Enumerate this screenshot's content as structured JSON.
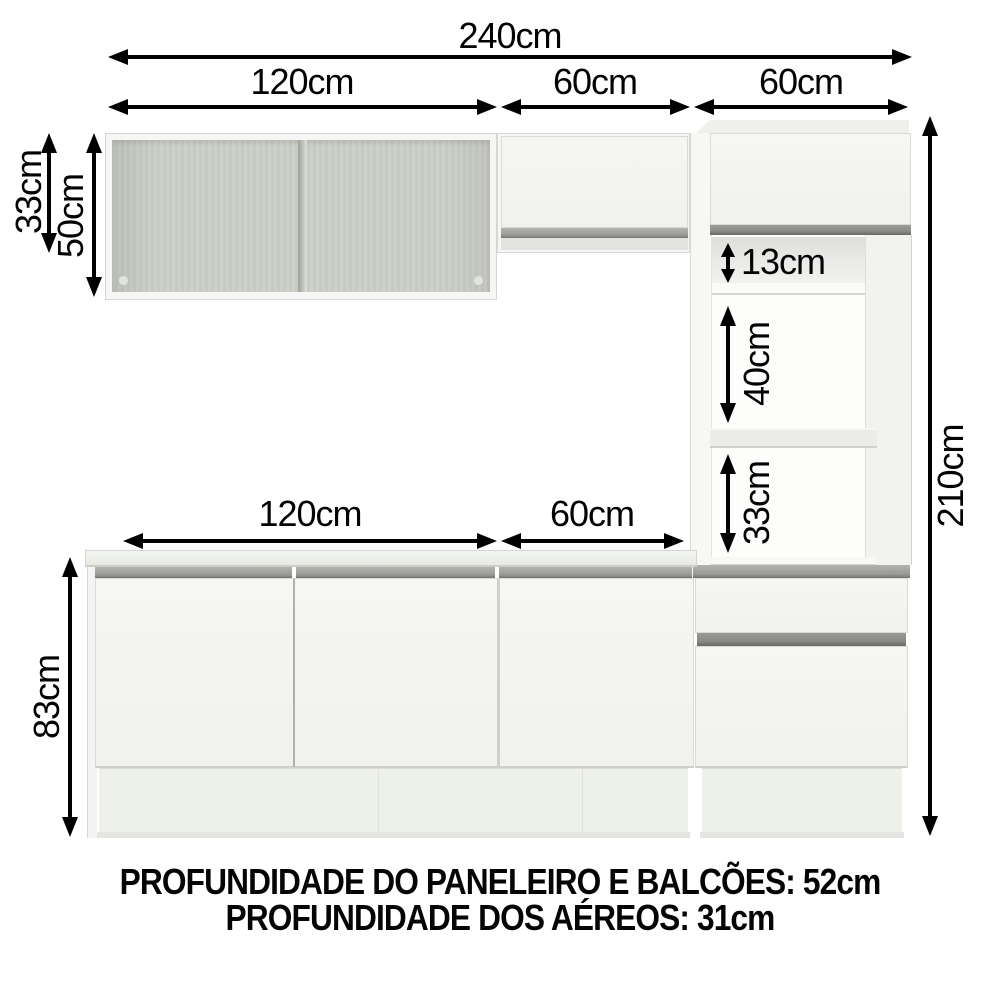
{
  "diagram": {
    "type": "kitchen-cabinet-dimension-diagram",
    "footer_line1": "PROFUNDIDADE DO PANELEIRO E BALCÕES: 52cm",
    "footer_line2": "PROFUNDIDADE DOS AÉREOS: 31cm"
  },
  "labels": {
    "w240": "240cm",
    "w120_top": "120cm",
    "w60_top_mid": "60cm",
    "w60_top_right": "60cm",
    "h33_left": "33cm",
    "h50_left": "50cm",
    "n13": "13cm",
    "n40": "40cm",
    "n33": "33cm",
    "w120_base": "120cm",
    "w60_base": "60cm",
    "h83": "83cm",
    "h210": "210cm"
  },
  "colors": {
    "background": "#ffffff",
    "arrow": "#000000",
    "cabinet_face": "#f3f3f0",
    "handle_strip": "#9a9b96",
    "open_interior": "#cdd1c9",
    "niche_shadow": "#e3e4e1",
    "outline": "#d7d7d3"
  }
}
